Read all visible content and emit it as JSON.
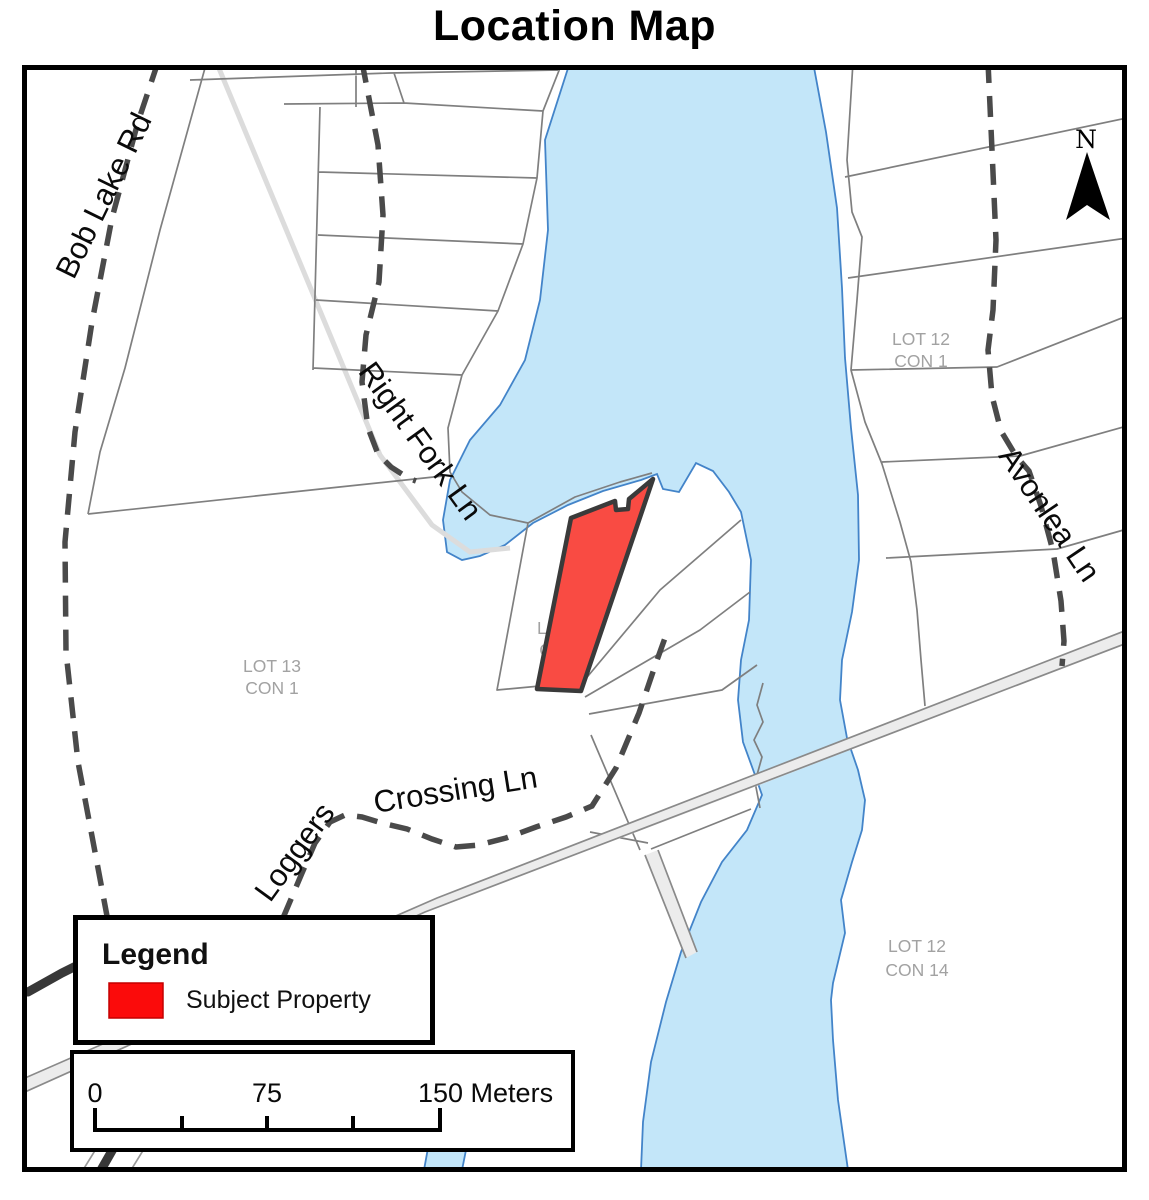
{
  "title": "Location Map",
  "colors": {
    "water_fill": "#c3e6f9",
    "water_outline": "#4384c9",
    "subject_property_fill": "#f94b43",
    "parcel_line": "#7f7f7f",
    "road_dashed": "#4a4a4a",
    "lot_label": "#a2a2a2"
  },
  "map": {
    "roads": {
      "bob_lake_rd": "Bob Lake Rd",
      "right_fork_ln": "Right Fork Ln",
      "loggers_crossing_ln_word1": "Loggers",
      "loggers_crossing_ln_rest": "Crossing Ln",
      "avonlea_ln": "Avonlea Ln"
    },
    "lots": {
      "lot13_con1": {
        "line1": "LOT 13",
        "line2": "CON 1"
      },
      "lot12_con1_subject": {
        "line1": "LOT 12",
        "line2": "CON 1"
      },
      "lot12_con1_east": {
        "line1": "LOT 12",
        "line2": "CON 1"
      },
      "lot12_con14": {
        "line1": "LOT 12",
        "line2": "CON 14"
      }
    },
    "north_arrow_label": "N"
  },
  "legend": {
    "title": "Legend",
    "items": [
      {
        "label": "Subject Property",
        "color": "#fb0b0b"
      }
    ]
  },
  "scale_bar": {
    "label_start": "0",
    "label_mid": "75",
    "label_end": "150 Meters"
  }
}
